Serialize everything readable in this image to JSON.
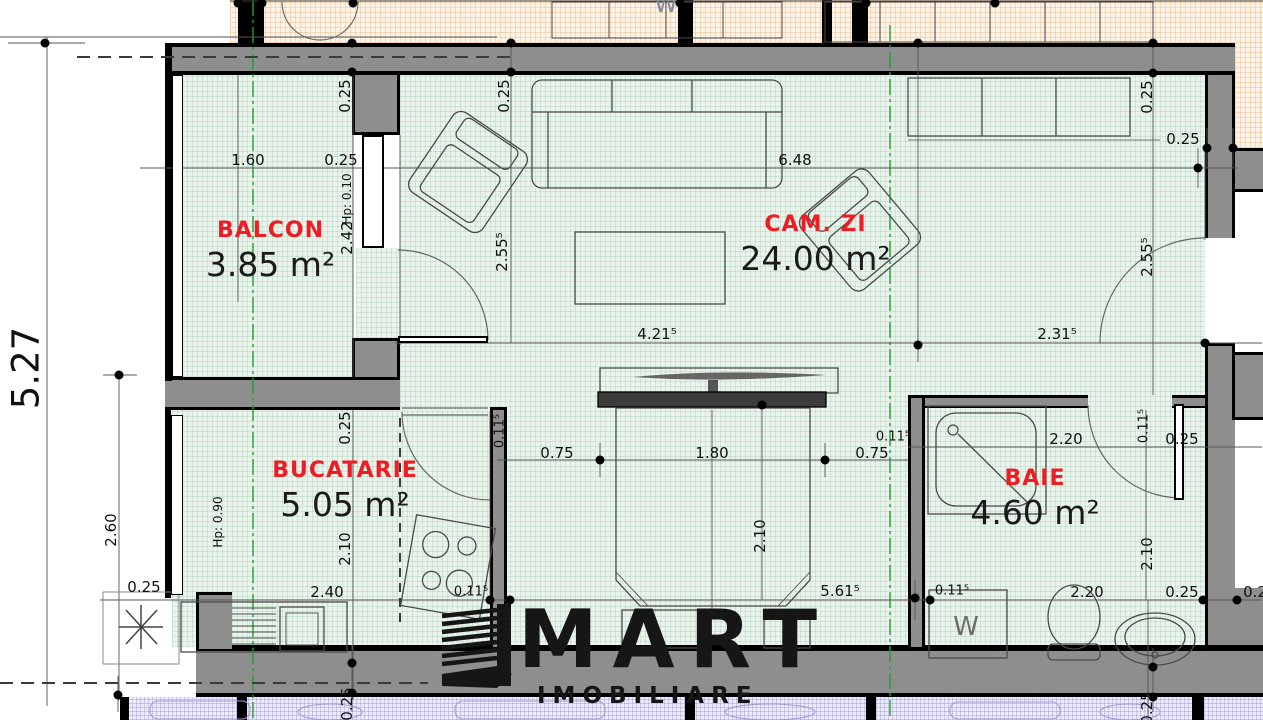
{
  "plan": {
    "rooms": [
      {
        "name": "BALCON",
        "area": "3.85 m²"
      },
      {
        "name": "CAM. ZI",
        "area": "24.00 m²"
      },
      {
        "name": "BUCATARIE",
        "area": "5.05 m²"
      },
      {
        "name": "BAIE",
        "area": "4.60 m²"
      }
    ],
    "appliance_labels": {
      "washer": "W",
      "neighbor_washer": "W"
    },
    "watermark": {
      "brand": "MART",
      "subtitle": "IMOBILIARE"
    },
    "colors": {
      "floor": "#eaf4ec",
      "wall": "#8e8e8e",
      "room_label": "#ee1c24",
      "neighbor_top": "#fdf3e6",
      "neighbor_bottom": "#edebfa",
      "section_line": "#1fa32a",
      "watermark": "#161616"
    },
    "dimensions": [
      {
        "t": "1.60",
        "x": 248,
        "y": 160
      },
      {
        "t": "0.25",
        "x": 341,
        "y": 160
      },
      {
        "t": "6.48",
        "x": 795,
        "y": 160
      },
      {
        "t": "0.25",
        "x": 1183,
        "y": 139
      },
      {
        "t": "0.25",
        "x": 345,
        "y": 96,
        "r": -90
      },
      {
        "t": "Hp: 0.10",
        "x": 347,
        "y": 199,
        "r": -90,
        "s": 12
      },
      {
        "t": "2.42",
        "x": 347,
        "y": 238,
        "r": -90
      },
      {
        "t": "0.25",
        "x": 504,
        "y": 96,
        "r": -90
      },
      {
        "t": "2.55⁵",
        "x": 502,
        "y": 252,
        "r": -90
      },
      {
        "t": "0.25",
        "x": 1147,
        "y": 97,
        "r": -90
      },
      {
        "t": "2.55⁵",
        "x": 1147,
        "y": 257,
        "r": -90
      },
      {
        "t": "4.21⁵",
        "x": 657,
        "y": 334
      },
      {
        "t": "2.31⁵",
        "x": 1057,
        "y": 334
      },
      {
        "t": "5.27",
        "x": 26,
        "y": 368,
        "r": -90,
        "s": 37
      },
      {
        "t": "2.60",
        "x": 111,
        "y": 530,
        "r": -90
      },
      {
        "t": "Hp: 0.90",
        "x": 218,
        "y": 522,
        "r": -90,
        "s": 12
      },
      {
        "t": "0.25",
        "x": 345,
        "y": 428,
        "r": -90
      },
      {
        "t": "2.10",
        "x": 345,
        "y": 549,
        "r": -90
      },
      {
        "t": "0.11⁵",
        "x": 500,
        "y": 431,
        "r": -90,
        "s": 13
      },
      {
        "t": "0.75",
        "x": 557,
        "y": 453
      },
      {
        "t": "1.80",
        "x": 712,
        "y": 453
      },
      {
        "t": "0.75",
        "x": 872,
        "y": 453
      },
      {
        "t": "0.11⁵",
        "x": 893,
        "y": 437,
        "s": 13
      },
      {
        "t": "2.10",
        "x": 760,
        "y": 536,
        "r": -90
      },
      {
        "t": "0.11⁵",
        "x": 1144,
        "y": 426,
        "r": -90,
        "s": 13
      },
      {
        "t": "2.20",
        "x": 1066,
        "y": 439
      },
      {
        "t": "0.25",
        "x": 1182,
        "y": 439
      },
      {
        "t": "2.10",
        "x": 1147,
        "y": 554,
        "r": -90
      },
      {
        "t": "0.25",
        "x": 144,
        "y": 587
      },
      {
        "t": "2.40",
        "x": 327,
        "y": 592
      },
      {
        "t": "0.11⁵",
        "x": 471,
        "y": 592,
        "s": 13
      },
      {
        "t": "5.61⁵",
        "x": 840,
        "y": 591
      },
      {
        "t": "0.11⁵",
        "x": 952,
        "y": 591,
        "s": 13
      },
      {
        "t": "2.20",
        "x": 1087,
        "y": 592
      },
      {
        "t": "0.25",
        "x": 1182,
        "y": 592
      },
      {
        "t": "0.2",
        "x": 1255,
        "y": 592
      },
      {
        "t": "0.25",
        "x": 347,
        "y": 704,
        "r": -90
      },
      {
        "t": "0.25",
        "x": 1147,
        "y": 708,
        "r": -90
      }
    ],
    "markers": [
      [
        45,
        43
      ],
      [
        238,
        3
      ],
      [
        262,
        3
      ],
      [
        353,
        3
      ],
      [
        680,
        3
      ],
      [
        866,
        3
      ],
      [
        995,
        3
      ],
      [
        352,
        43
      ],
      [
        352,
        72
      ],
      [
        511,
        43
      ],
      [
        511,
        72
      ],
      [
        918,
        43
      ],
      [
        1153,
        43
      ],
      [
        1153,
        73
      ],
      [
        1207,
        148
      ],
      [
        1233,
        148
      ],
      [
        1198,
        168
      ],
      [
        918,
        345
      ],
      [
        1205,
        343
      ],
      [
        762,
        405
      ],
      [
        600,
        460
      ],
      [
        825,
        460
      ],
      [
        119,
        375
      ],
      [
        490,
        600
      ],
      [
        510,
        600
      ],
      [
        915,
        598
      ],
      [
        930,
        600
      ],
      [
        1203,
        600
      ],
      [
        1237,
        600
      ],
      [
        1153,
        667
      ],
      [
        1153,
        697
      ],
      [
        352,
        663
      ],
      [
        352,
        693
      ],
      [
        118,
        695
      ]
    ]
  }
}
